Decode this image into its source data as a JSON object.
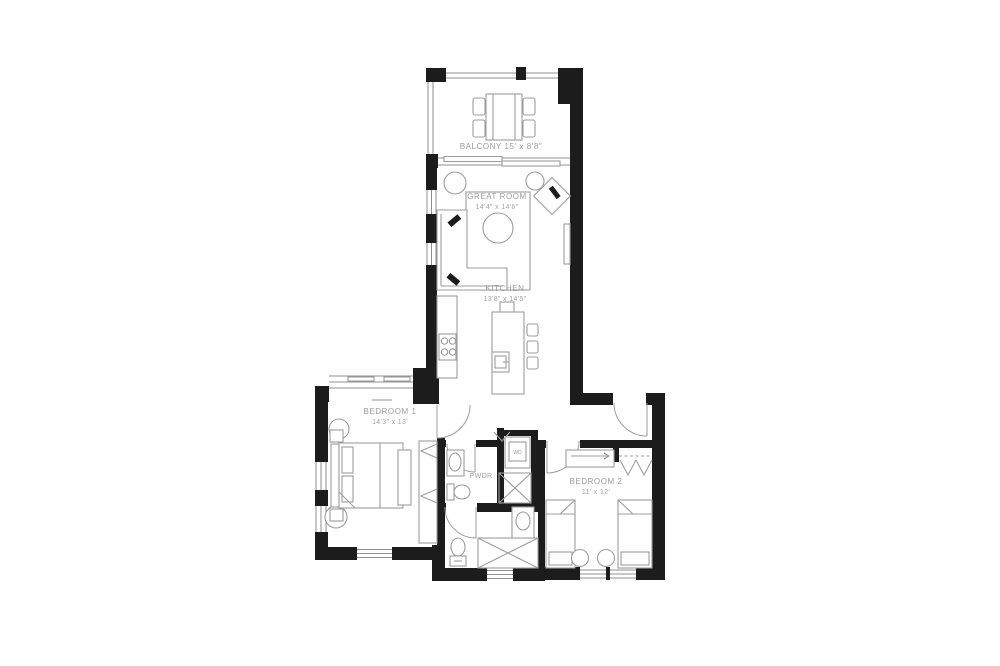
{
  "rooms": {
    "balcony": {
      "label": "BALCONY 15' x 8'8\""
    },
    "great_room": {
      "name": "GREAT ROOM",
      "dims": "14'4\" x 14'6\""
    },
    "kitchen": {
      "name": "KITCHEN",
      "dims": "13'8\" x 14'5\""
    },
    "bedroom1": {
      "name": "BEDROOM 1",
      "dims": "14'3\" x 13'"
    },
    "pwdr": {
      "name": "PWDR"
    },
    "bedroom2": {
      "name": "BEDROOM 2",
      "dims": "11' x 12'"
    },
    "laundry": {
      "name": "WD"
    }
  },
  "colors": {
    "wall": "#1c1c1c",
    "furniture_line": "#9d9d9d",
    "label_text": "#9c9c9c",
    "background": "#ffffff"
  }
}
